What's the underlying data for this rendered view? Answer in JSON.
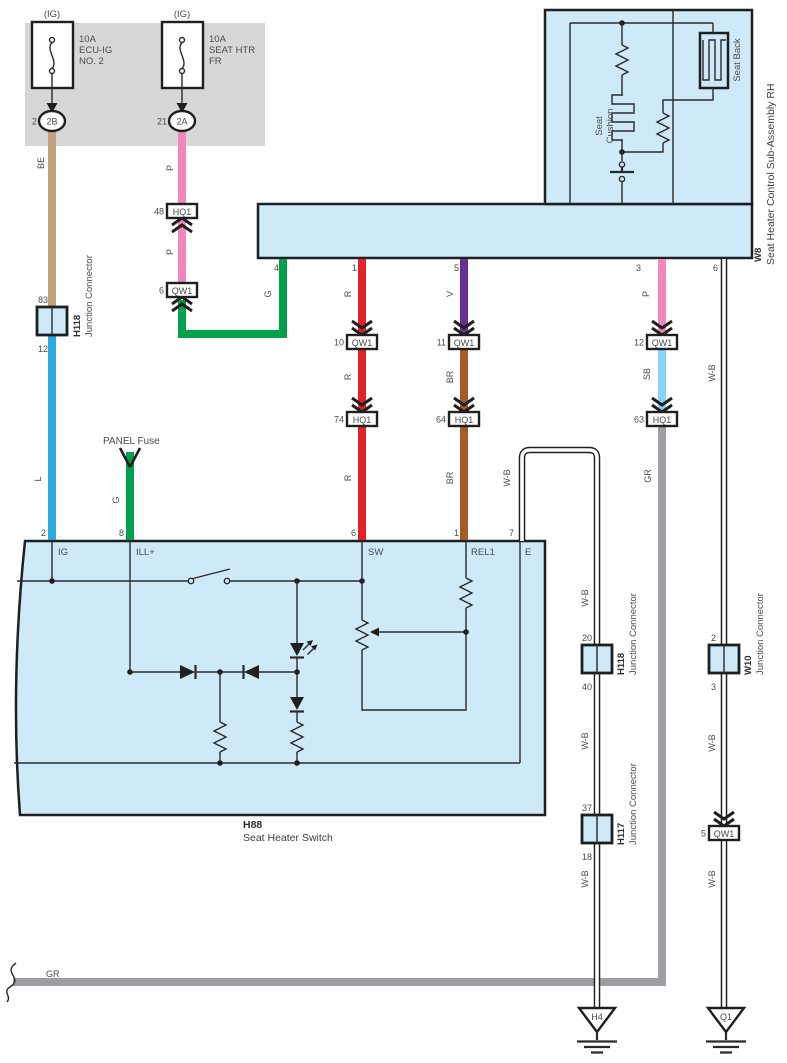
{
  "fuse_panel": {
    "fuse1": {
      "tag": "(IG)",
      "rating": "10A",
      "name1": "ECU-IG",
      "name2": "NO. 2",
      "pin": "2",
      "connector": "2B"
    },
    "fuse2": {
      "tag": "(IG)",
      "rating": "10A",
      "name1": "SEAT HTR",
      "name2": "FR",
      "pin": "21",
      "connector": "2A"
    }
  },
  "panel_fuse_label": "PANEL Fuse",
  "wire_colors": {
    "be": "BE",
    "pink": "P",
    "blue": "L",
    "green": "G",
    "red": "R",
    "violet": "V",
    "brown": "BR",
    "sky_blue": "SB",
    "gray": "GR",
    "white_black": "W-B"
  },
  "colors": {
    "tan": "#c2a183",
    "pink": "#f287bd",
    "blue": "#2ca9e1",
    "green": "#00a04c",
    "red": "#e32128",
    "violet": "#6b2e91",
    "brown": "#a55a28",
    "sky_blue": "#86d5f5",
    "gray_wire": "#9c9ea1",
    "box_fill": "#cee9f8",
    "panel_fill": "#d7d7d7"
  },
  "w8": {
    "code": "W8",
    "name": "Seat Heater Control Sub-Assembly RH",
    "cushion_line1": "Seat",
    "cushion_line2": "Cushion",
    "back_label": "Seat Back",
    "pin_4": "4",
    "pin_1": "1",
    "pin_5": "5",
    "pin_3": "3",
    "pin_6": "6"
  },
  "h88": {
    "code": "H88",
    "name": "Seat Heater Switch",
    "pin_2": "2",
    "pin_8": "8",
    "pin_6": "6",
    "pin_1": "1",
    "pin_7": "7",
    "term_ig": "IG",
    "term_ill": "ILL+",
    "term_sw": "SW",
    "term_rel1": "REL1",
    "term_e": "E"
  },
  "inline_connectors": {
    "hq1_48": {
      "pin": "48",
      "code": "HQ1"
    },
    "qw1_6": {
      "pin": "6",
      "code": "QW1"
    },
    "qw1_10": {
      "pin": "10",
      "code": "QW1"
    },
    "qw1_11": {
      "pin": "11",
      "code": "QW1"
    },
    "qw1_12": {
      "pin": "12",
      "code": "QW1"
    },
    "hq1_74": {
      "pin": "74",
      "code": "HQ1"
    },
    "hq1_64": {
      "pin": "64",
      "code": "HQ1"
    },
    "hq1_63": {
      "pin": "63",
      "code": "HQ1"
    },
    "qw1_5": {
      "pin": "5",
      "code": "QW1"
    }
  },
  "junction_connectors": {
    "h118_left": {
      "code": "H118",
      "name": "Junction Connector",
      "pin_top": "83",
      "pin_bottom": "12"
    },
    "h118_right": {
      "code": "H118",
      "name": "Junction Connector",
      "pin_top": "20",
      "pin_bottom": "40"
    },
    "h117": {
      "code": "H117",
      "name": "Junction Connector",
      "pin_top": "37",
      "pin_bottom": "18"
    },
    "w10": {
      "code": "W10",
      "name": "Junction Connector",
      "pin_top": "2",
      "pin_bottom": "3"
    }
  },
  "grounds": {
    "h4": "H4",
    "q1": "Q1"
  },
  "bottom_wire_label": "GR"
}
